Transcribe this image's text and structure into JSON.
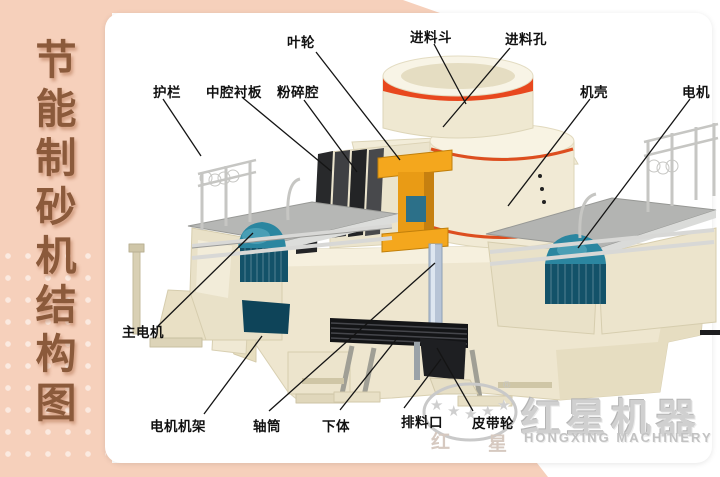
{
  "sidebar": {
    "title": "节能制砂机结构图",
    "chars": [
      "节",
      "能",
      "制",
      "砂",
      "机",
      "结",
      "构",
      "图"
    ]
  },
  "labels": [
    {
      "id": "impeller",
      "text": "叶轮",
      "x": 287,
      "y": 31,
      "line": [
        316,
        52,
        400,
        160
      ]
    },
    {
      "id": "feed-hopper",
      "text": "进料斗",
      "x": 410,
      "y": 26,
      "line": [
        434,
        44,
        466,
        104
      ]
    },
    {
      "id": "feed-port",
      "text": "进料孔",
      "x": 505,
      "y": 28,
      "line": [
        510,
        48,
        443,
        127
      ]
    },
    {
      "id": "guardrail",
      "text": "护栏",
      "x": 153,
      "y": 81,
      "line": [
        163,
        99,
        201,
        156
      ]
    },
    {
      "id": "cavity-liner",
      "text": "中腔衬板",
      "x": 206,
      "y": 81,
      "line": [
        243,
        98,
        331,
        171
      ]
    },
    {
      "id": "crushing-chamber",
      "text": "粉碎腔",
      "x": 277,
      "y": 81,
      "line": [
        304,
        100,
        357,
        172
      ]
    },
    {
      "id": "casing",
      "text": "机壳",
      "x": 580,
      "y": 81,
      "line": [
        590,
        99,
        508,
        206
      ]
    },
    {
      "id": "motor",
      "text": "电机",
      "x": 682,
      "y": 81,
      "line": [
        690,
        99,
        578,
        248
      ]
    },
    {
      "id": "main-motor",
      "text": "主电机",
      "x": 122,
      "y": 321,
      "line": [
        158,
        326,
        253,
        233
      ]
    },
    {
      "id": "motor-frame",
      "text": "电机机架",
      "x": 150,
      "y": 415,
      "line": [
        204,
        414,
        262,
        336
      ]
    },
    {
      "id": "shaft-tube",
      "text": "轴筒",
      "x": 253,
      "y": 415,
      "line": [
        269,
        411,
        435,
        263
      ]
    },
    {
      "id": "lower-body",
      "text": "下体",
      "x": 322,
      "y": 415,
      "line": [
        340,
        410,
        398,
        337
      ]
    },
    {
      "id": "discharge-port",
      "text": "排料口",
      "x": 401,
      "y": 411,
      "line": [
        404,
        408,
        441,
        359
      ]
    },
    {
      "id": "belt-pulley",
      "text": "皮带轮",
      "x": 472,
      "y": 412,
      "line": [
        473,
        411,
        437,
        348
      ]
    }
  ],
  "watermark": {
    "brand_cn": "红星机器",
    "brand_en": "HONGXING MACHINERY",
    "logo_char_left": "红",
    "logo_char_right": "星",
    "registered": "®",
    "star_glyph": "★",
    "star_count": 5
  },
  "colors": {
    "frame_pink": "#f6d0bb",
    "title_brown": "#8b5a3b",
    "body_cream": "#f0e9d4",
    "accent_red": "#e8481e",
    "impeller_orange": "#f2a71d",
    "motor_teal": "#176582",
    "liner_dark": "#2c2d2f",
    "platform_gray": "#b6b7b5",
    "watermark_gray": "#cbcbcb",
    "label_black": "#111111"
  }
}
